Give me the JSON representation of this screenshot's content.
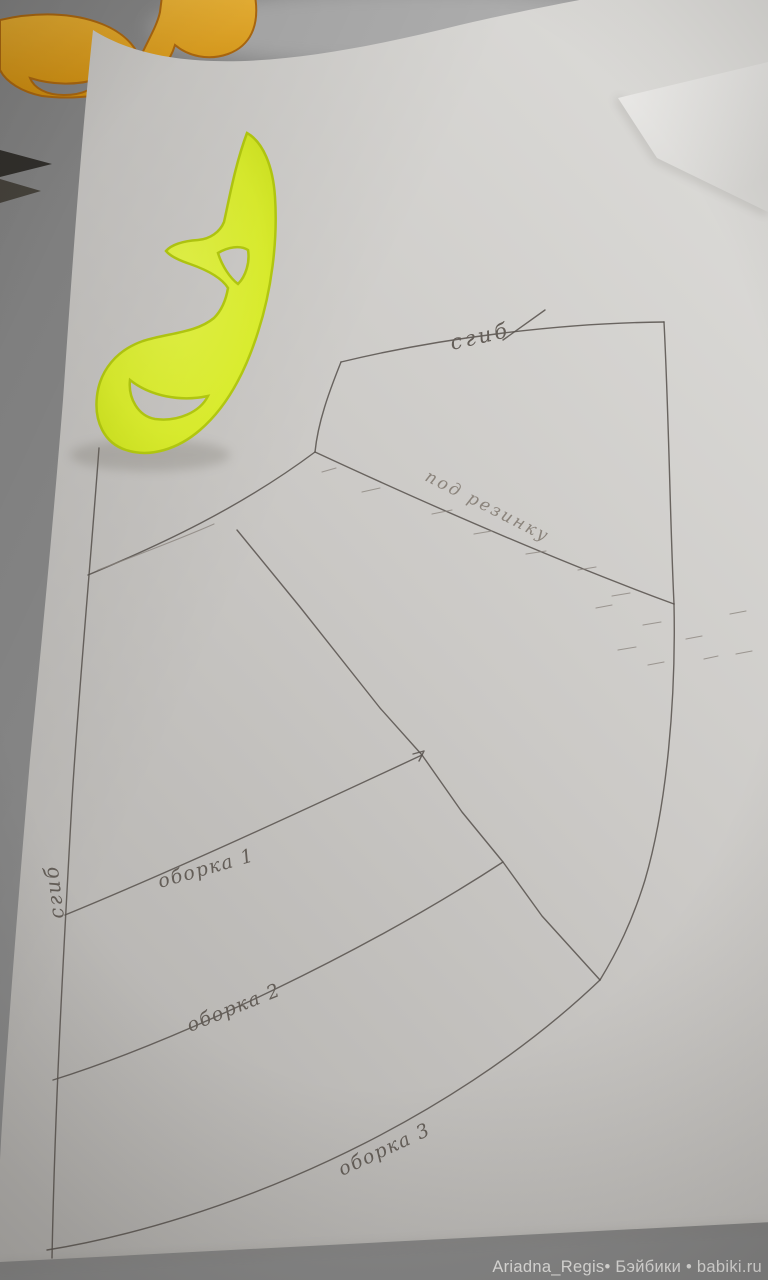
{
  "labels": {
    "fold_top": "сгиб",
    "fold_left": "сгиб",
    "waistband": "под резинку",
    "ruffle_1": "оборка 1",
    "ruffle_2": "оборка 2",
    "ruffle_3": "оборка 3"
  },
  "watermark": {
    "text": "Ariadna_Regis• Бэйбики • babiki.ru"
  },
  "colors": {
    "yellow_ruler": "#ddf02e",
    "orange_ruler": "#e5a227",
    "paper": "#cecdca",
    "table": "#b0ada9",
    "pencil": "#5a5450",
    "watermark_text": "#e9e8e6"
  }
}
